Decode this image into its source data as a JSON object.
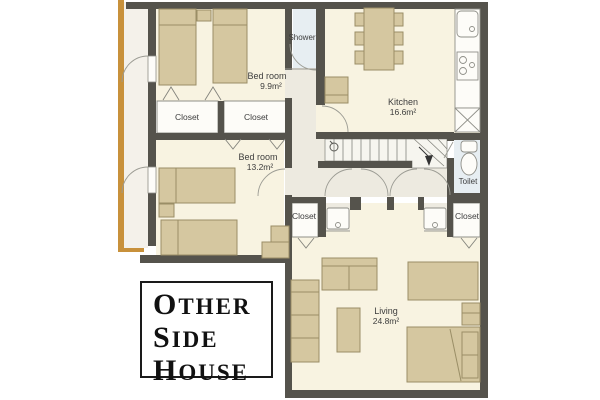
{
  "floor_plan": {
    "labels": {
      "bedroom1_name": "Bed room",
      "bedroom1_area": "9.9m²",
      "bedroom2_name": "Bed room",
      "bedroom2_area": "13.2m²",
      "kitchen_name": "Kitchen",
      "kitchen_area": "16.6m²",
      "living_name": "Living",
      "living_area": "24.8m²",
      "shower": "Shower",
      "toilet": "Toilet",
      "closet": "Closet"
    },
    "title_box": {
      "lines": [
        "Other",
        "Side",
        "House"
      ]
    },
    "icons": [
      "toilet-icon",
      "sink-icon",
      "stove-icon",
      "fridge-icon",
      "washbasin-icon",
      "bed-icon",
      "sofa-icon",
      "table-icon",
      "stairs-icon",
      "stairs-down-arrow-icon",
      "door-arc-icon",
      "closet-fold-mark-icon"
    ],
    "colors": {
      "wall": "#55534c",
      "room_floor": "#f8f3e1",
      "hall_floor": "#edeae0",
      "wet_room": "#e7eef2",
      "furniture": "#d5c7a0",
      "furniture_line": "#9a8e66",
      "balcony_edge": "#c8913b",
      "fixture_white": "#fdfcf8",
      "title_text": "#111111"
    }
  }
}
